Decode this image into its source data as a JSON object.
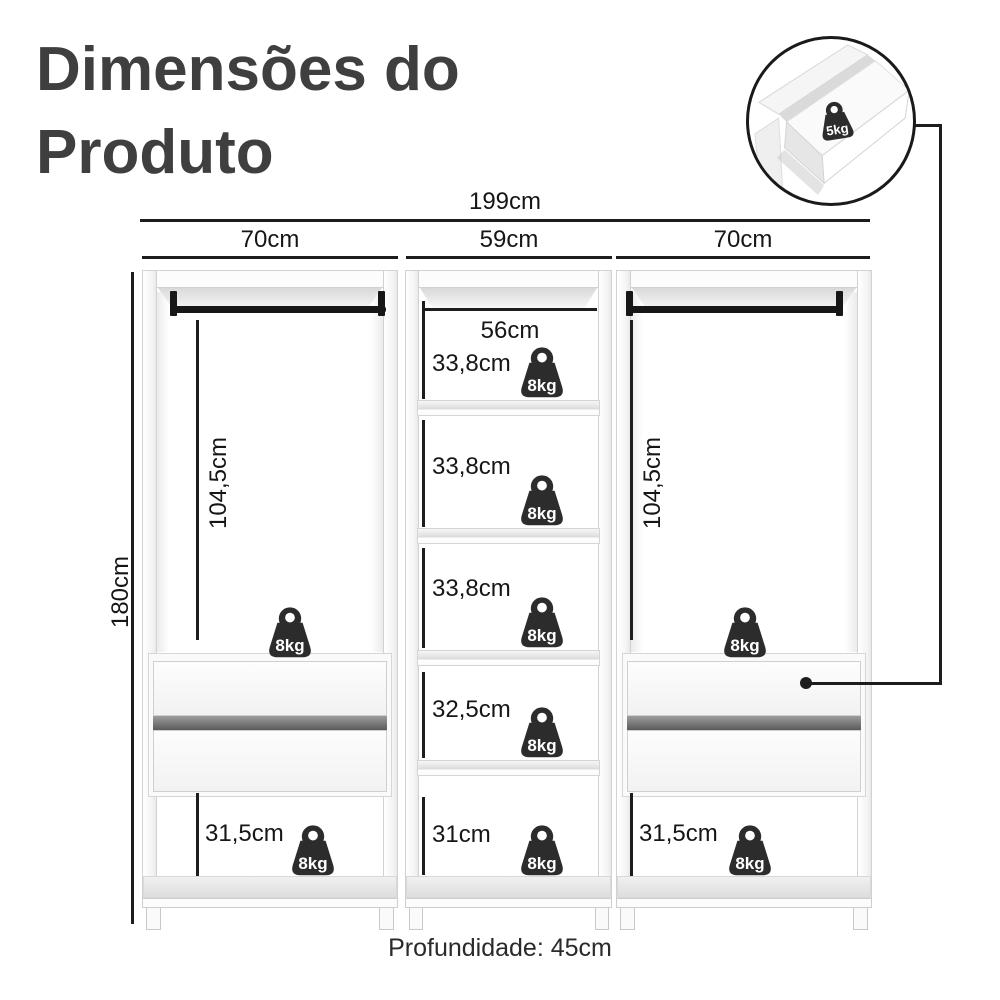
{
  "title": {
    "line1": "Dimensões do",
    "line2": "Produto"
  },
  "dims": {
    "total_width": "199cm",
    "left_width": "70cm",
    "middle_width": "59cm",
    "right_width": "70cm",
    "height": "180cm",
    "left_hanging": "104,5cm",
    "right_hanging": "104,5cm",
    "middle_shelf_width": "56cm",
    "middle_gaps": [
      "33,8cm",
      "33,8cm",
      "33,8cm",
      "32,5cm",
      "31cm"
    ],
    "left_bottom": "31,5cm",
    "right_bottom": "31,5cm",
    "depth": "Profundidade: 45cm"
  },
  "capacities": {
    "shelf": "8kg",
    "drawer": "5kg"
  },
  "icons": {
    "shelf_weight": "weight-icon",
    "drawer_weight": "weight-icon",
    "inset_illustration": "open-drawer-illustration"
  },
  "colors": {
    "line": "#1d1d1d",
    "title_text": "#3f3f3f",
    "weight_fill": "#2c2c2c",
    "furniture_edge": "#d4d4d4",
    "shading": "#e8e8e8"
  }
}
